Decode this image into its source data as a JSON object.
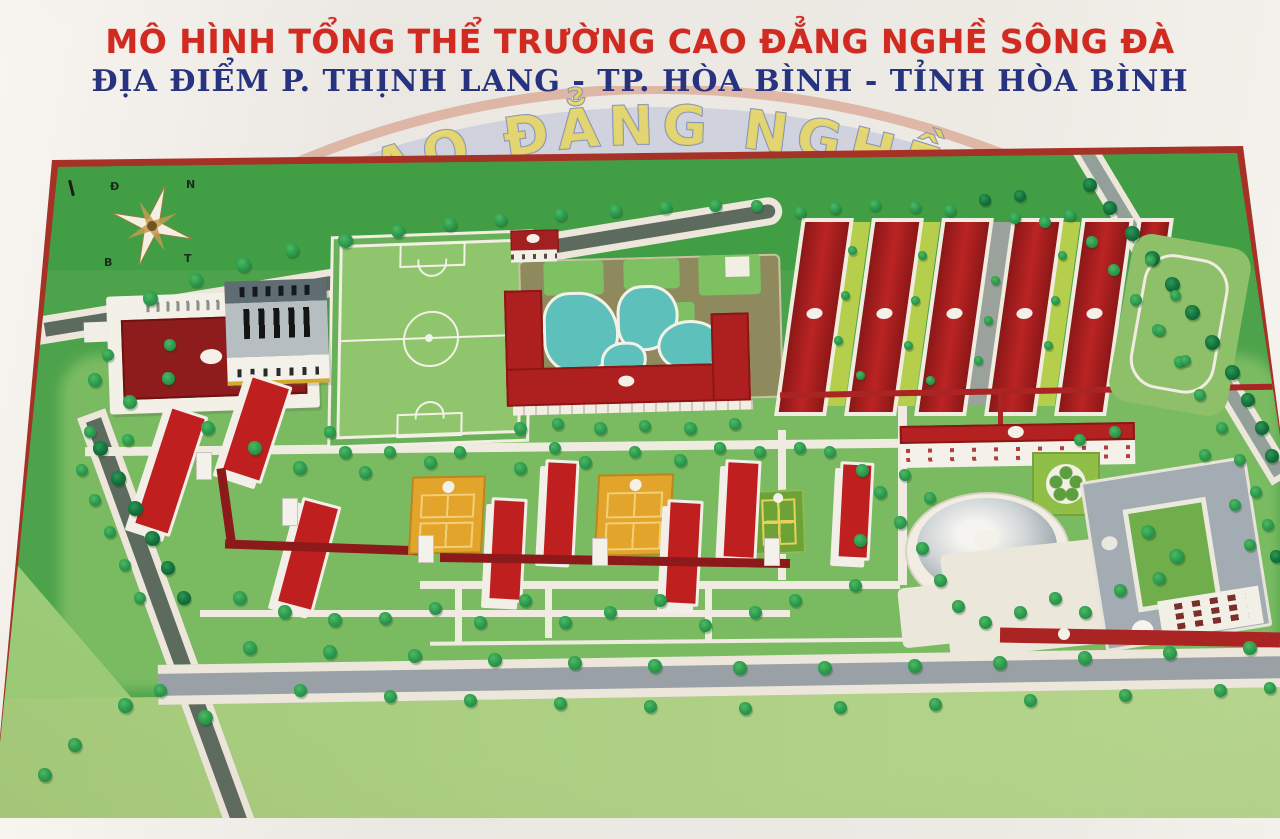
{
  "header": {
    "title": "MÔ HÌNH TỔNG THỂ TRƯỜNG CAO ĐẲNG NGHỀ SÔNG ĐÀ",
    "subtitle": "ĐỊA ĐIỂM P. THỊNH LANG - TP. HÒA BÌNH - TỈNH HÒA BÌNH",
    "title_color": "#d02a21",
    "subtitle_color": "#27337e",
    "watermark_text": "AO ĐẲNG NGHỀ"
  },
  "compass": {
    "nw": "Đ",
    "ne": "N",
    "sw": "B",
    "se": "T"
  },
  "map": {
    "frame_color": "#a63127",
    "palette": {
      "grass_dark": "#419e45",
      "grass_mid": "#7abb62",
      "grass_light": "#abce81",
      "road_dark": "#5d6b5f",
      "road_gray": "#99a1a6",
      "path_white": "#f0ebe0",
      "roof_red": "#c01f1f",
      "roof_dark_red": "#8e1c1c",
      "roof_gray": "#a3acb2",
      "pool_teal": "#5ec0ba",
      "court_amber": "#e3a42c",
      "wall_white": "#f2efe8",
      "tree_green": "#2f9e50",
      "tree_dark": "#15713d"
    },
    "trees": [
      [
        150,
        298,
        15,
        0
      ],
      [
        196,
        280,
        14,
        0
      ],
      [
        243,
        264,
        15,
        0
      ],
      [
        292,
        250,
        14,
        0
      ],
      [
        345,
        240,
        15,
        0
      ],
      [
        398,
        231,
        14,
        0
      ],
      [
        450,
        224,
        14,
        0
      ],
      [
        500,
        219,
        13,
        0
      ],
      [
        560,
        214,
        13,
        0
      ],
      [
        615,
        210,
        13,
        0
      ],
      [
        665,
        207,
        13,
        0
      ],
      [
        715,
        205,
        13,
        0
      ],
      [
        757,
        206,
        12,
        0
      ],
      [
        800,
        212,
        12,
        0
      ],
      [
        835,
        208,
        12,
        0
      ],
      [
        875,
        205,
        12,
        0
      ],
      [
        915,
        207,
        12,
        0
      ],
      [
        950,
        210,
        12,
        0
      ],
      [
        985,
        200,
        12,
        1
      ],
      [
        1020,
        196,
        12,
        1
      ],
      [
        1015,
        218,
        12,
        0
      ],
      [
        1045,
        222,
        12,
        0
      ],
      [
        1090,
        185,
        14,
        1
      ],
      [
        1110,
        208,
        14,
        1
      ],
      [
        1132,
        233,
        15,
        1
      ],
      [
        1152,
        258,
        15,
        1
      ],
      [
        1172,
        284,
        15,
        1
      ],
      [
        1192,
        312,
        15,
        1
      ],
      [
        1212,
        342,
        15,
        1
      ],
      [
        1232,
        372,
        15,
        1
      ],
      [
        1248,
        400,
        14,
        1
      ],
      [
        1262,
        428,
        14,
        1
      ],
      [
        1272,
        456,
        14,
        1
      ],
      [
        1070,
        215,
        12,
        0
      ],
      [
        1092,
        242,
        12,
        0
      ],
      [
        1114,
        270,
        12,
        0
      ],
      [
        1136,
        300,
        12,
        0
      ],
      [
        1158,
        330,
        12,
        0
      ],
      [
        1180,
        362,
        12,
        0
      ],
      [
        1200,
        395,
        12,
        0
      ],
      [
        1222,
        428,
        12,
        0
      ],
      [
        1240,
        460,
        12,
        0
      ],
      [
        1256,
        492,
        12,
        0
      ],
      [
        1268,
        525,
        12,
        0
      ],
      [
        1276,
        556,
        13,
        1
      ],
      [
        100,
        448,
        15,
        1
      ],
      [
        118,
        478,
        15,
        1
      ],
      [
        135,
        508,
        15,
        1
      ],
      [
        152,
        538,
        15,
        1
      ],
      [
        168,
        568,
        14,
        1
      ],
      [
        184,
        598,
        14,
        1
      ],
      [
        82,
        470,
        12,
        0
      ],
      [
        95,
        500,
        12,
        0
      ],
      [
        110,
        532,
        12,
        0
      ],
      [
        125,
        565,
        12,
        0
      ],
      [
        140,
        598,
        12,
        0
      ],
      [
        90,
        432,
        12,
        0
      ],
      [
        128,
        440,
        12,
        0
      ],
      [
        125,
        705,
        15,
        0
      ],
      [
        205,
        717,
        15,
        0
      ],
      [
        75,
        745,
        14,
        0
      ],
      [
        45,
        775,
        14,
        0
      ],
      [
        160,
        690,
        13,
        0
      ],
      [
        250,
        648,
        14,
        0
      ],
      [
        330,
        652,
        14,
        0
      ],
      [
        415,
        656,
        14,
        0
      ],
      [
        495,
        660,
        14,
        0
      ],
      [
        575,
        663,
        14,
        0
      ],
      [
        655,
        666,
        14,
        0
      ],
      [
        740,
        668,
        14,
        0
      ],
      [
        825,
        668,
        14,
        0
      ],
      [
        915,
        666,
        14,
        0
      ],
      [
        1000,
        663,
        14,
        0
      ],
      [
        1085,
        658,
        14,
        0
      ],
      [
        1170,
        653,
        14,
        0
      ],
      [
        1250,
        648,
        14,
        0
      ],
      [
        300,
        690,
        13,
        0
      ],
      [
        390,
        696,
        13,
        0
      ],
      [
        470,
        700,
        13,
        0
      ],
      [
        560,
        703,
        13,
        0
      ],
      [
        650,
        706,
        13,
        0
      ],
      [
        745,
        708,
        13,
        0
      ],
      [
        840,
        707,
        13,
        0
      ],
      [
        935,
        704,
        13,
        0
      ],
      [
        1030,
        700,
        13,
        0
      ],
      [
        1125,
        695,
        13,
        0
      ],
      [
        1220,
        690,
        13,
        0
      ],
      [
        1270,
        688,
        12,
        0
      ],
      [
        95,
        380,
        14,
        0
      ],
      [
        130,
        402,
        14,
        0
      ],
      [
        168,
        378,
        13,
        0
      ],
      [
        208,
        428,
        14,
        0
      ],
      [
        255,
        448,
        14,
        0
      ],
      [
        300,
        468,
        14,
        0
      ],
      [
        345,
        452,
        13,
        0
      ],
      [
        330,
        432,
        12,
        0
      ],
      [
        365,
        472,
        13,
        0
      ],
      [
        390,
        452,
        12,
        0
      ],
      [
        430,
        462,
        13,
        0
      ],
      [
        460,
        452,
        12,
        0
      ],
      [
        520,
        468,
        13,
        0
      ],
      [
        555,
        448,
        12,
        0
      ],
      [
        585,
        462,
        13,
        0
      ],
      [
        635,
        452,
        12,
        0
      ],
      [
        680,
        460,
        13,
        0
      ],
      [
        720,
        448,
        12,
        0
      ],
      [
        760,
        452,
        12,
        0
      ],
      [
        800,
        448,
        12,
        0
      ],
      [
        830,
        452,
        12,
        0
      ],
      [
        862,
        470,
        13,
        0
      ],
      [
        880,
        492,
        13,
        0
      ],
      [
        900,
        522,
        13,
        0
      ],
      [
        922,
        548,
        13,
        0
      ],
      [
        940,
        580,
        13,
        0
      ],
      [
        958,
        606,
        13,
        0
      ],
      [
        985,
        622,
        13,
        0
      ],
      [
        1020,
        612,
        13,
        0
      ],
      [
        1055,
        598,
        13,
        0
      ],
      [
        1085,
        612,
        13,
        0
      ],
      [
        1120,
        590,
        13,
        0
      ],
      [
        860,
        540,
        13,
        0
      ],
      [
        855,
        585,
        13,
        0
      ],
      [
        905,
        475,
        12,
        0
      ],
      [
        930,
        498,
        12,
        0
      ],
      [
        520,
        428,
        13,
        0
      ],
      [
        558,
        424,
        12,
        0
      ],
      [
        600,
        428,
        13,
        0
      ],
      [
        645,
        426,
        12,
        0
      ],
      [
        690,
        428,
        13,
        0
      ],
      [
        735,
        424,
        12,
        0
      ],
      [
        240,
        598,
        14,
        0
      ],
      [
        285,
        612,
        14,
        0
      ],
      [
        335,
        620,
        14,
        0
      ],
      [
        385,
        618,
        13,
        0
      ],
      [
        435,
        608,
        13,
        0
      ],
      [
        480,
        622,
        13,
        0
      ],
      [
        525,
        600,
        13,
        0
      ],
      [
        565,
        622,
        13,
        0
      ],
      [
        610,
        612,
        13,
        0
      ],
      [
        660,
        600,
        13,
        0
      ],
      [
        705,
        625,
        13,
        0
      ],
      [
        755,
        612,
        13,
        0
      ],
      [
        795,
        600,
        13,
        0
      ],
      [
        108,
        355,
        12,
        0
      ],
      [
        170,
        345,
        12,
        0
      ],
      [
        852,
        250,
        9,
        0
      ],
      [
        845,
        295,
        9,
        0
      ],
      [
        838,
        340,
        9,
        0
      ],
      [
        922,
        255,
        9,
        0
      ],
      [
        915,
        300,
        9,
        0
      ],
      [
        908,
        345,
        9,
        0
      ],
      [
        1062,
        255,
        9,
        0
      ],
      [
        1055,
        300,
        9,
        0
      ],
      [
        1048,
        345,
        9,
        0
      ],
      [
        995,
        280,
        9,
        0
      ],
      [
        988,
        320,
        9,
        0
      ],
      [
        978,
        360,
        9,
        0
      ],
      [
        860,
        375,
        9,
        0
      ],
      [
        930,
        380,
        9,
        0
      ],
      [
        1150,
        260,
        11,
        0
      ],
      [
        1175,
        295,
        11,
        0
      ],
      [
        1160,
        330,
        11,
        0
      ],
      [
        1185,
        360,
        11,
        0
      ],
      [
        1080,
        440,
        12,
        0
      ],
      [
        1115,
        432,
        12,
        0
      ],
      [
        1205,
        455,
        12,
        0
      ],
      [
        1235,
        505,
        12,
        0
      ],
      [
        1250,
        545,
        12,
        0
      ]
    ]
  }
}
